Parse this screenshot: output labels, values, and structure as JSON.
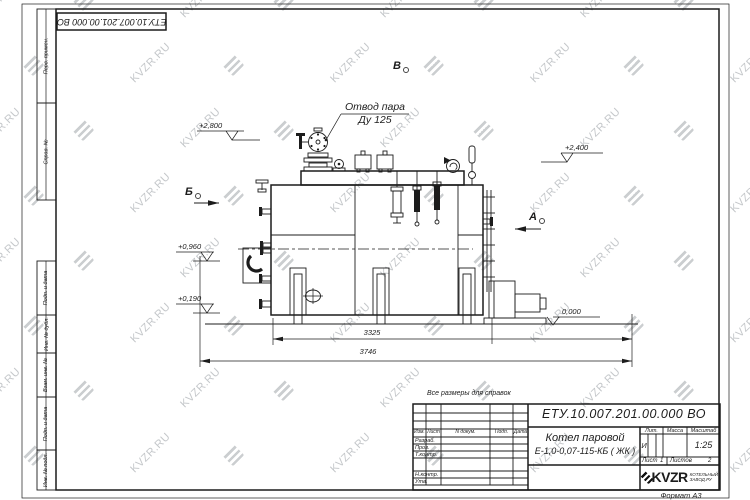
{
  "watermark": {
    "text": "KVZR.RU"
  },
  "top_stamp": {
    "text": "ЕТУ.10.007.201.00.000  ВО"
  },
  "margin": {
    "labels": [
      "Перв. примен.",
      "Справ. №",
      "Подп. и дата",
      "Инв. № дубл.",
      "Взам. инв. №",
      "Подп. и дата",
      "Инв. № подл."
    ]
  },
  "drawing": {
    "note": "Все размеры для справок",
    "leader": {
      "line1": "Отвод пара",
      "line2": "Ду 125"
    },
    "views": {
      "left": "Б",
      "top": "В",
      "right": "А"
    },
    "elevations": {
      "steam_outlet": "+2,800",
      "drum_top": "+2,400",
      "burner_axis": "+0,960",
      "burner_bottom": "+0,190",
      "ground": "0,000"
    },
    "dimensions": {
      "boiler_length": "3325",
      "overall_length": "3746"
    }
  },
  "title_block": {
    "designation": "ЕТУ.10.007.201.00.000  ВО",
    "product_name_line1": "Котел паровой",
    "product_name_line2": "Е-1,0-0,07-115-КБ ( ЖК )",
    "columns": {
      "izm": "Изм.",
      "list": "Лист",
      "ndoc": "N докум.",
      "podp": "Подп.",
      "data": "Дата"
    },
    "rows": {
      "razrab": "Разраб.",
      "prov": "Пров.",
      "tkontr": "Т.контр.",
      "nkontr": "Н.контр.",
      "utv": "Утв."
    },
    "lit_header": "Лит.",
    "lit_value": "И",
    "mass_header": "Масса",
    "scale_header": "Масштаб",
    "scale_value": "1:25",
    "sheet_label": "Лист",
    "sheet_value": "1",
    "sheets_label": "Листов",
    "sheets_value": "2",
    "logo": {
      "text": "KVZR",
      "sub_line1": "КОТЕЛЬНЫЙ",
      "sub_line2": "ЗАВОД.РУ"
    },
    "format_note": "Формат А3"
  }
}
